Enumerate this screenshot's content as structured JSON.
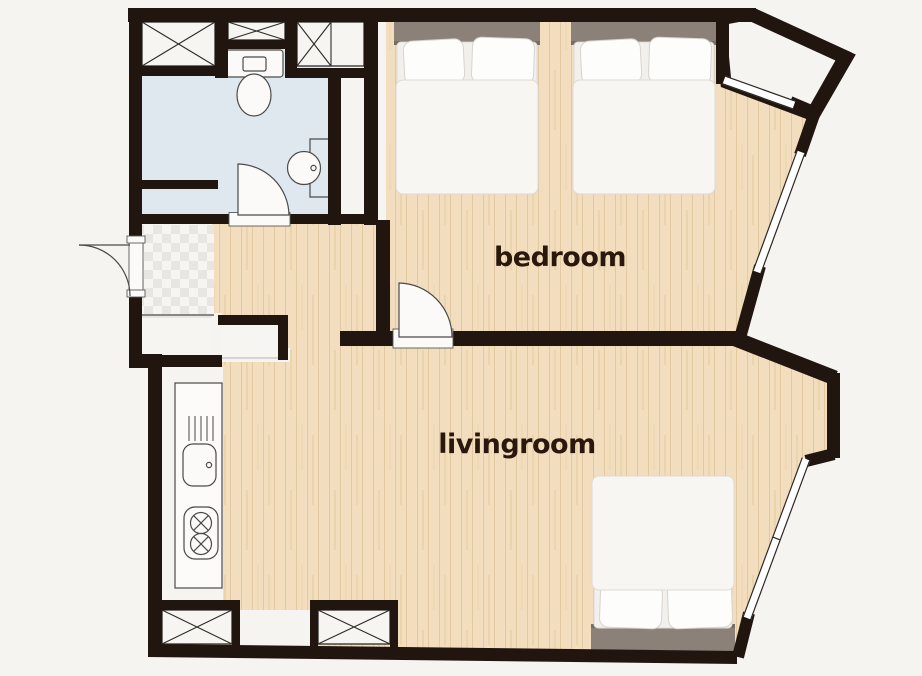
{
  "title": "Apartment floor plan",
  "rooms": {
    "bedroom": {
      "label": "bedroom"
    },
    "livingroom": {
      "label": "livingroom"
    },
    "unlabeled_areas": [
      "bathroom",
      "entry-hall",
      "kitchen",
      "balcony"
    ]
  },
  "fixtures": {
    "items": [
      "double-bed",
      "double-bed",
      "double-bed",
      "toilet",
      "washbasin",
      "kitchen-sink",
      "two-burner-stove",
      "wardrobe",
      "wardrobe",
      "wardrobe",
      "wardrobe",
      "wardrobe",
      "entrance-door",
      "bathroom-door",
      "bedroom-door",
      "window",
      "window",
      "window"
    ]
  },
  "colors": {
    "wall": "#211510",
    "wood_floor": "#f2debe",
    "wood_grain": "#e2c9a0",
    "bathroom_floor": "#dfe8ee",
    "tile_light": "#f7f5f2",
    "tile_dark": "#e9e6e1",
    "background": "#f5f4f1",
    "bed_headboard": "#8b8178",
    "bed_linen": "#f7f6f3",
    "label_text": "#2b180c"
  }
}
